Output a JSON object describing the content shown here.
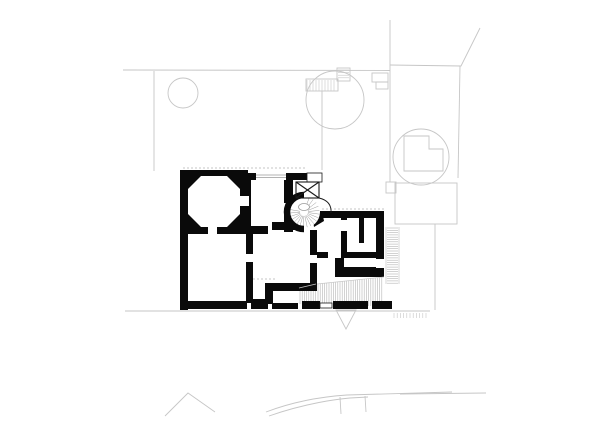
{
  "meta": {
    "title": "architectural-ground-floor-plan-with-site-context",
    "canvas": {
      "width": 600,
      "height": 424
    },
    "background": "#ffffff"
  },
  "palette": {
    "wall": "#0a0a0a",
    "thin": "#1a1a1a",
    "context": "#c6c6c6",
    "hatch": "#b4b4b4",
    "glazing": "#9a9a9a",
    "white": "#ffffff"
  },
  "plan": {
    "wall_rects": [
      [
        180,
        170,
        68,
        64
      ],
      [
        180,
        170,
        8,
        140
      ],
      [
        244,
        173,
        63,
        7
      ],
      [
        244,
        173,
        7,
        60
      ],
      [
        284,
        178,
        9,
        54
      ],
      [
        272,
        222,
        30,
        8
      ],
      [
        216,
        226,
        52,
        8
      ],
      [
        246,
        229,
        7,
        74
      ],
      [
        265,
        283,
        51,
        8
      ],
      [
        265,
        283,
        8,
        21
      ],
      [
        310,
        230,
        7,
        61
      ],
      [
        320,
        211,
        62,
        7
      ],
      [
        376,
        211,
        8,
        62
      ],
      [
        341,
        218,
        6,
        34
      ],
      [
        359,
        218,
        5,
        25
      ],
      [
        313,
        252,
        64,
        6
      ],
      [
        335,
        252,
        9,
        25
      ],
      [
        341,
        267,
        43,
        10
      ],
      [
        185,
        301,
        62,
        8
      ],
      [
        251,
        299,
        17,
        10
      ],
      [
        272,
        303,
        26,
        6
      ],
      [
        302,
        301,
        18,
        8
      ],
      [
        333,
        301,
        35,
        8
      ],
      [
        372,
        301,
        20,
        8
      ]
    ],
    "wall_polys": [
      [
        [
          312,
          214
        ],
        [
          322,
          211
        ],
        [
          324,
          221
        ],
        [
          314,
          227
        ]
      ]
    ],
    "octagon": [
      [
        201,
        176
      ],
      [
        227,
        176
      ],
      [
        240,
        189
      ],
      [
        240,
        214
      ],
      [
        227,
        227
      ],
      [
        201,
        227
      ],
      [
        188,
        214
      ],
      [
        188,
        189
      ]
    ],
    "door_gaps": [
      [
        208,
        224,
        9,
        11
      ],
      [
        236,
        196,
        13,
        10
      ],
      [
        256,
        173,
        30,
        7
      ],
      [
        284,
        203,
        9,
        11
      ],
      [
        246,
        254,
        7,
        8
      ],
      [
        310,
        255,
        7,
        8
      ],
      [
        341,
        220,
        6,
        11
      ],
      [
        328,
        252,
        13,
        6
      ],
      [
        376,
        259,
        8,
        9
      ]
    ],
    "stair": {
      "cx": 304,
      "cy": 212,
      "r": 16,
      "hub": {
        "cx": 304,
        "cy": 207,
        "rx": 5.5,
        "ry": 3.5
      },
      "surround_path": "M304,229 A17,17 0 0 1 287,212 A17,17 0 0 1 304,195",
      "surround_width": 6.5,
      "tread_inner": 4,
      "tread_outer": 15.5,
      "tread_angles": [
        -70,
        -54,
        -38,
        -22,
        -6,
        8,
        22,
        36,
        50,
        64,
        78,
        92,
        106,
        120,
        134,
        148,
        162,
        176,
        190
      ]
    },
    "shaft": {
      "box": [
        296,
        182,
        23,
        16
      ],
      "upper_box": [
        307,
        173,
        15,
        9
      ],
      "curve": "M319,198 Q332,201 331,213"
    },
    "glazing_lines": [
      [
        256,
        175,
        286,
        175
      ],
      [
        256,
        177.5,
        286,
        177.5
      ]
    ],
    "thin_rects": [
      [
        320,
        303,
        12,
        5
      ]
    ],
    "thin_lines": [
      [
        386,
        227,
        386,
        284
      ],
      [
        399,
        227,
        399,
        284
      ],
      [
        317,
        284,
        384,
        277
      ],
      [
        299,
        288,
        316,
        284
      ]
    ],
    "hatches": [
      {
        "dir": "v",
        "start": 300,
        "end": 316,
        "step": 2.2,
        "t0": 289,
        "t1": 285,
        "b0": 304,
        "b1": 305,
        "color": "hatch"
      },
      {
        "dir": "v",
        "start": 318,
        "end": 383,
        "step": 2.2,
        "t0": 284,
        "t1": 277,
        "b0": 306,
        "b1": 306,
        "color": "hatch"
      },
      {
        "dir": "h",
        "start": 228,
        "end": 284,
        "step": 2.3,
        "t0": 387,
        "t1": 387,
        "b0": 398,
        "b1": 398,
        "color": "hatch"
      },
      {
        "dir": "v",
        "start": 307,
        "end": 336,
        "step": 3.0,
        "t0": 80,
        "t1": 80,
        "b0": 91,
        "b1": 91,
        "color": "context"
      },
      {
        "dir": "h",
        "start": 70,
        "end": 80,
        "step": 2.6,
        "t0": 338,
        "t1": 338,
        "b0": 349,
        "b1": 349,
        "color": "context"
      },
      {
        "dir": "v",
        "start": 394,
        "end": 428,
        "step": 3.2,
        "t0": 313,
        "t1": 313,
        "b0": 318,
        "b1": 318,
        "color": "context"
      }
    ],
    "context": {
      "lines": [
        [
          123,
          70,
          390,
          70.5
        ],
        [
          154,
          71,
          154,
          171
        ],
        [
          322,
          91,
          322,
          170
        ],
        [
          390,
          20,
          390,
          182
        ],
        [
          460,
          66,
          458,
          178
        ],
        [
          435,
          224,
          435,
          310
        ],
        [
          125,
          311,
          430,
          311
        ],
        [
          400,
          394,
          486,
          393
        ],
        [
          340,
          397,
          341,
          414
        ],
        [
          365,
          396,
          366,
          412
        ]
      ],
      "polylines": [
        [
          [
            390,
            65
          ],
          [
            461,
            66
          ],
          [
            480,
            28
          ]
        ],
        [
          [
            165,
            416
          ],
          [
            188,
            393
          ],
          [
            215,
            412
          ]
        ]
      ],
      "circles": [
        [
          183,
          93,
          15
        ],
        [
          335,
          100,
          29
        ],
        [
          421,
          157,
          28
        ]
      ],
      "rects": [
        [
          395,
          183,
          62,
          41
        ],
        [
          386,
          182,
          10,
          11
        ],
        [
          306,
          79,
          32,
          12
        ],
        [
          337,
          68,
          13,
          13
        ],
        [
          372,
          73,
          16,
          9
        ],
        [
          376,
          82,
          12,
          7
        ]
      ],
      "paths": [
        "M266,412 C300,399 332,396 347,395 L452,392",
        "M269,416 C306,403 338,399 350,398 L368,397",
        "M404,136 L404,171 L443,171 L443,149 L429,149 L429,136 Z"
      ],
      "dashed_lines": [
        [
          183,
          168,
          305,
          168
        ],
        [
          322,
          209,
          384,
          209
        ],
        [
          253,
          279,
          275,
          279
        ]
      ],
      "triangle": [
        [
          336,
          310
        ],
        [
          356,
          310
        ],
        [
          346,
          329
        ]
      ]
    }
  }
}
